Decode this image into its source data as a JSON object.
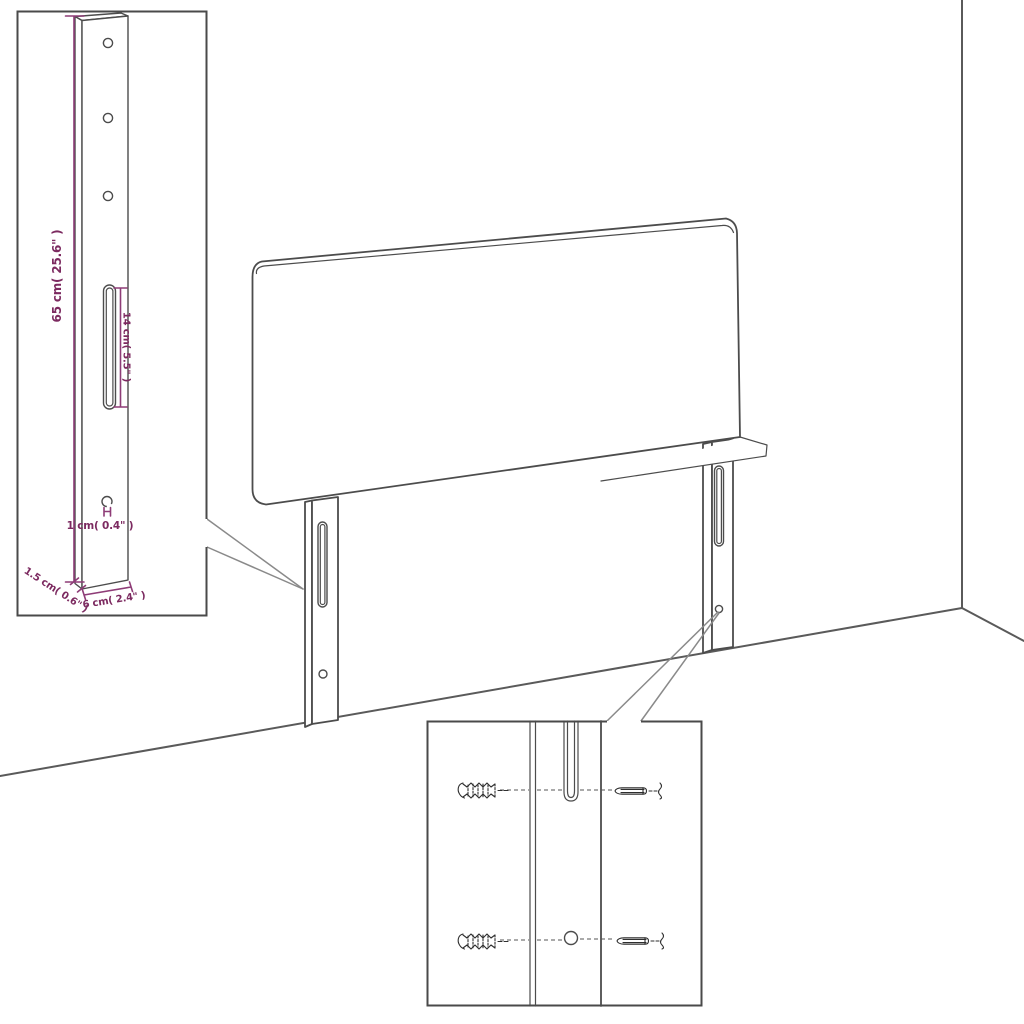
{
  "diagram": {
    "subject": "headboard-with-mounting-legs-assembly-diagram",
    "colors": {
      "background": "#ffffff",
      "outline": "#4c4c4c",
      "room_line": "#5a5a5a",
      "callout_line": "#8a8a8a",
      "dimension_line": "#8e3c77",
      "dimension_text": "#7c2a60",
      "hardware": "#2e2e2e"
    }
  },
  "bracket_inset": {
    "dim_height": "65 cm( 25.6\" )",
    "dim_slot": "14 cm( 5.5\" )",
    "dim_hole": "1 cm( 0.4\" )",
    "dim_depth": "1.5 cm( 0.6\" )",
    "dim_width": "6 cm( 2.4\" )",
    "round_hole_count": 4,
    "slot_count": 1
  },
  "mounting_inset": {
    "hardware": [
      "wall-plug",
      "screw"
    ],
    "rows": 2
  }
}
